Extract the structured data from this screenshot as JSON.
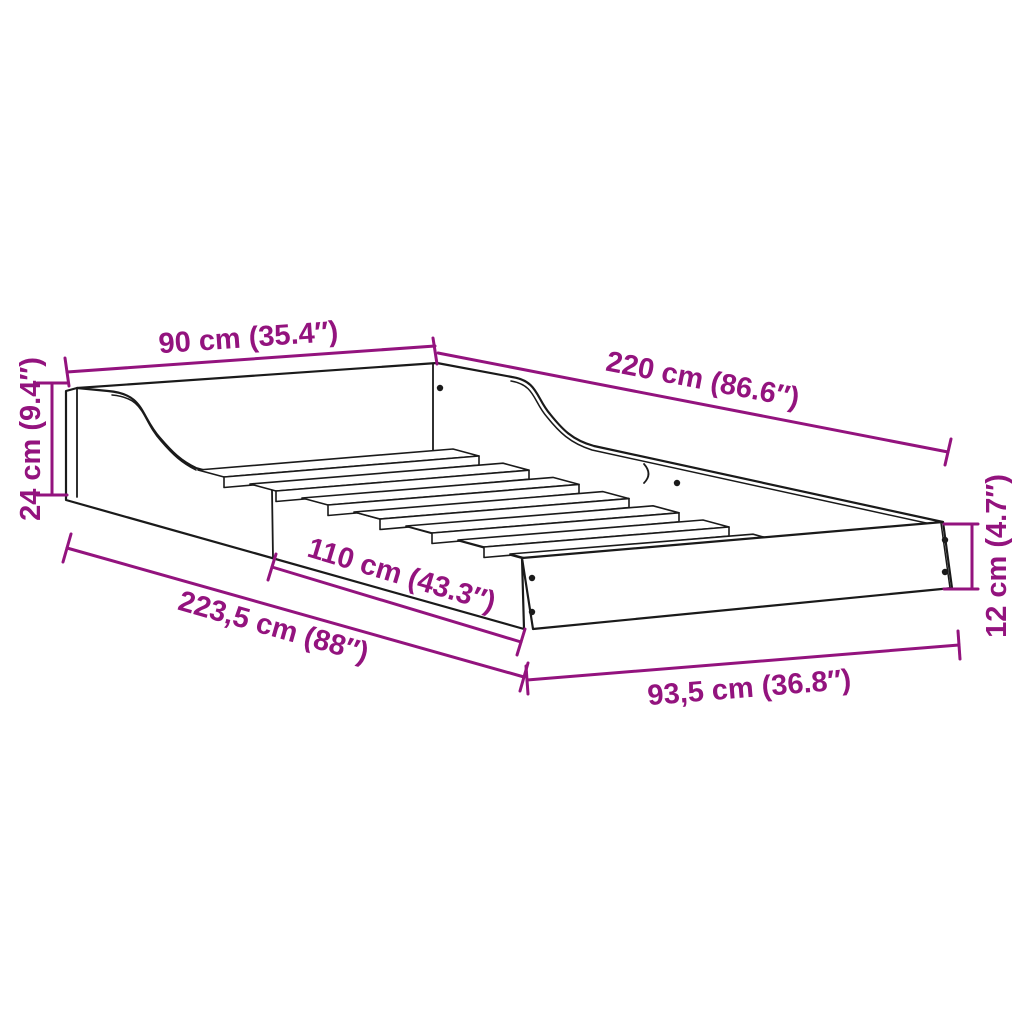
{
  "diagram": {
    "kind": "product-dimension-diagram",
    "subject": "bed-frame-with-slats",
    "background_color": "#ffffff",
    "accent_color": "#93137E",
    "line_color": "#1a1a1a",
    "dimensions": [
      {
        "id": "head-width",
        "label": "90 cm (35.4″)"
      },
      {
        "id": "inner-length",
        "label": "220 cm (86.6″)"
      },
      {
        "id": "head-height",
        "label": "24 cm (9.4″)"
      },
      {
        "id": "low-rail-length",
        "label": "110 cm (43.3″)"
      },
      {
        "id": "outer-length",
        "label": "223,5 cm (88″)"
      },
      {
        "id": "foot-width",
        "label": "93,5 cm (36.8″)"
      },
      {
        "id": "foot-height",
        "label": "12 cm (4.7″)"
      }
    ]
  }
}
